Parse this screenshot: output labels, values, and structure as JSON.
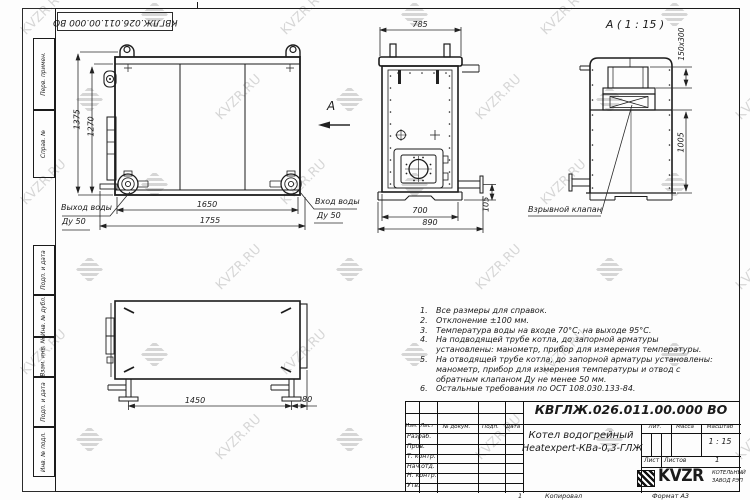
{
  "frame": {
    "doc_number_top": "КВГЛЖ.026.011.00.000 ВО",
    "stamps": [
      "Перв. примен.",
      "Справ. №",
      "Подп. и дата",
      "Инв. № дубл.",
      "Взам. инв. №",
      "Подп. и дата",
      "Инв. № подл."
    ],
    "bottom": {
      "copy_num": "1",
      "copied": "Копировал",
      "format": "Формат А3"
    }
  },
  "watermark": {
    "text": "KVZR.RU",
    "color": "#bdbdbd"
  },
  "front_view": {
    "dim_height_outer": "1375",
    "dim_height_inner": "1270",
    "dim_width_inner": "1650",
    "dim_width_outer": "1755",
    "outlet_label_1": "Выход воды",
    "outlet_label_2": "Ду 50",
    "inlet_label_1": "Вход воды",
    "inlet_label_2": "Ду 50",
    "view_letter": "А"
  },
  "side_view": {
    "dim_top": "785",
    "dim_bottom_inner": "700",
    "dim_bottom_outer": "890",
    "dim_right": "105"
  },
  "detail_view": {
    "title": "А ( 1 : 15 )",
    "dim_top": "150x300",
    "dim_side": "1005",
    "callout": "Взрывной клапан"
  },
  "plan_view": {
    "dim_width": "1450",
    "dim_offset": "80"
  },
  "notes": [
    {
      "n": "1.",
      "text": "Все размеры для справок."
    },
    {
      "n": "2.",
      "text": "Отклонение ±100 мм."
    },
    {
      "n": "3.",
      "text": "Температура воды на входе 70°С, на выходе 95°С."
    },
    {
      "n": "4.",
      "text": "На подводящей трубе котла, до запорной арматуры установлены: манометр, прибор для измерения температуры."
    },
    {
      "n": "5.",
      "text": "На отводящей трубе котла, до запорной арматуры установлены: манометр, прибор для измерения температуры и отвод с обратным клапаном Ду не менее 50 мм."
    },
    {
      "n": "6.",
      "text": "Остальные требования по ОСТ 108.030.133-84."
    }
  ],
  "title_block": {
    "doc_number": "КВГЛЖ.026.011.00.000 ВО",
    "product_line1": "Котел водогрейный",
    "product_line2": "Heatexpert-КВа-0,3-ГЛЖ",
    "cols": {
      "izm": "Изм.",
      "list": "Лист",
      "doc": "№ докум.",
      "podp": "Подп.",
      "data": "Дата"
    },
    "rows": [
      "Разраб.",
      "Пров.",
      "Т. контр.",
      "Нач.отд.",
      "Н. контр.",
      "Утв."
    ],
    "lit": "Лит.",
    "massa": "Масса",
    "masshtab": "Масштаб",
    "scale": "1 : 15",
    "sheet_label": "Лист",
    "sheets_label": "Листов",
    "sheets_value": "1",
    "logo": "KVZR",
    "logo_sub1": "КОТЕЛЬНЫЙ",
    "logo_sub2": "ЗАВОД РЭП"
  }
}
